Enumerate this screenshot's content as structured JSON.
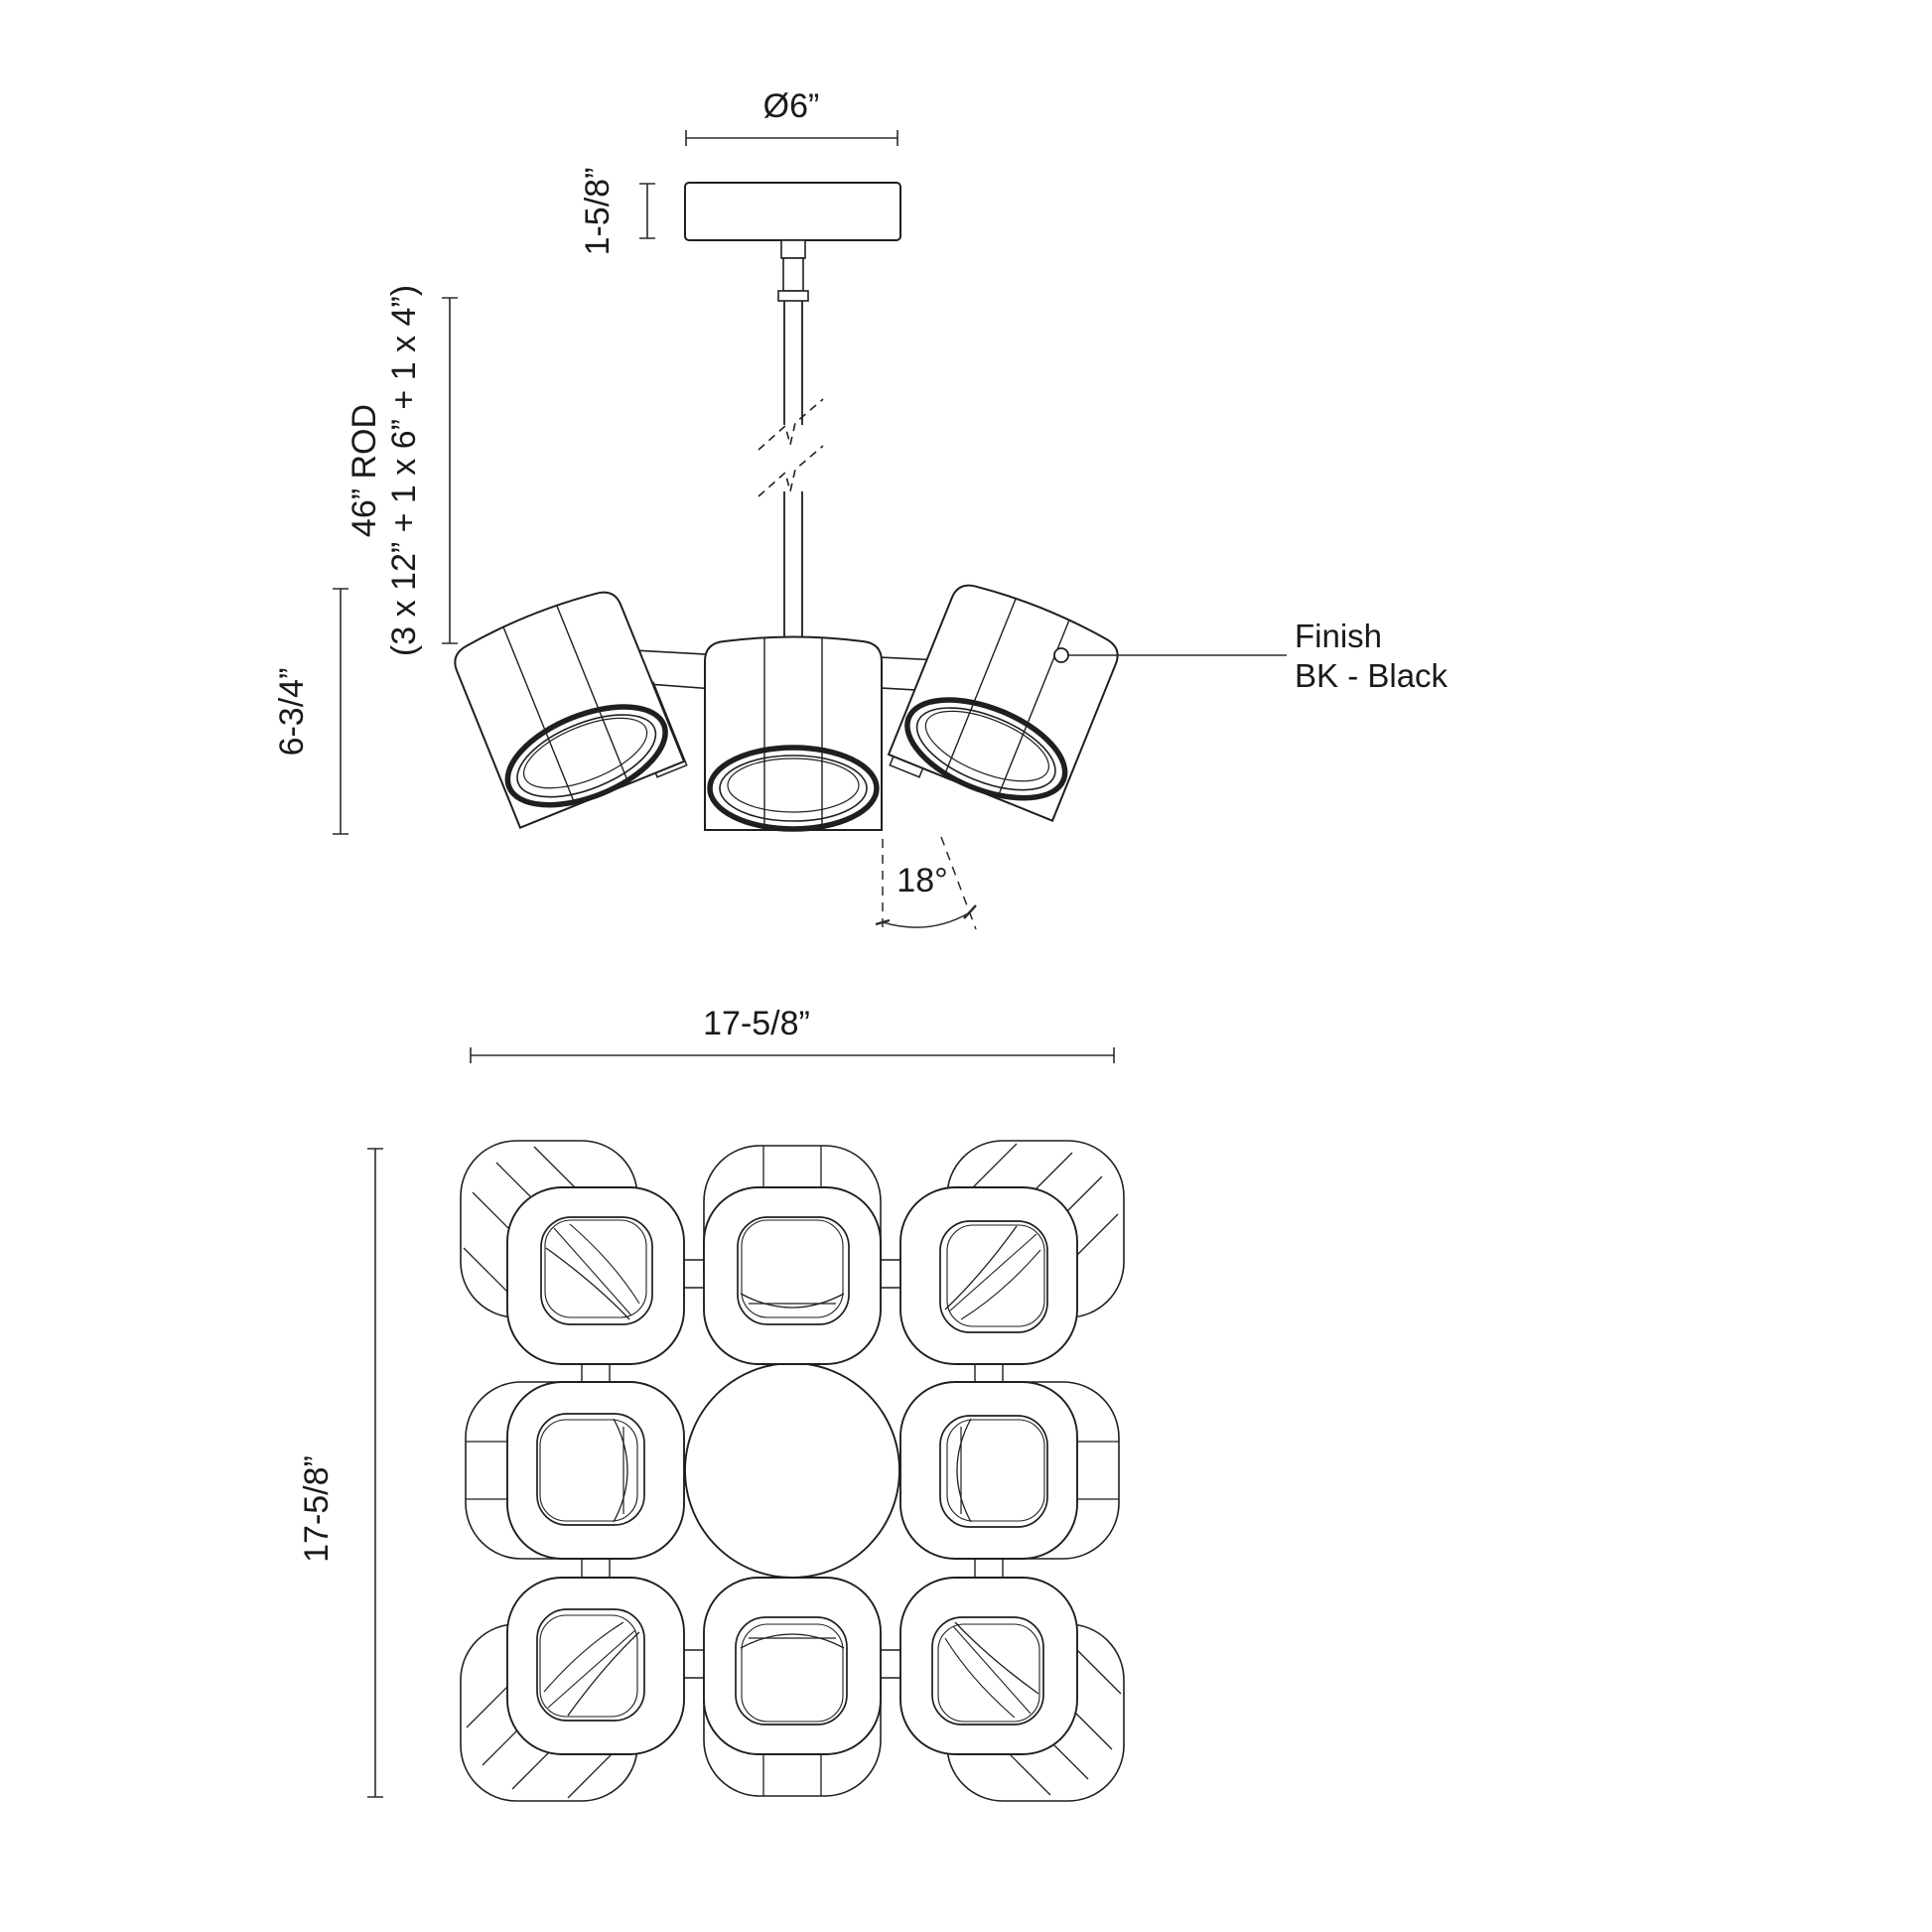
{
  "elevation": {
    "dim_canopy_diameter": "Ø6”",
    "dim_canopy_height": "1-5/8”",
    "dim_rod_line1": "46” ROD",
    "dim_rod_line2": "(3 x 12” + 1 x 6” + 1 x 4”)",
    "dim_fixture_height": "6-3/4”",
    "dim_tilt_angle": "18°",
    "finish_label_line1": "Finish",
    "finish_label_line2": "BK - Black"
  },
  "plan": {
    "dim_width": "17-5/8”",
    "dim_height": "17-5/8”"
  },
  "colors": {
    "line": "#1f1f1f",
    "dimension_line": "#2b2b2b",
    "background": "#ffffff"
  }
}
